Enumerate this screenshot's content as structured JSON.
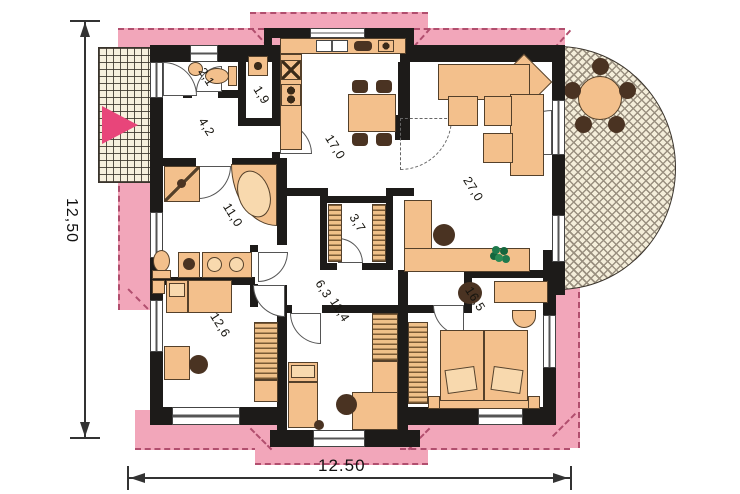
{
  "type": "floor-plan",
  "rooms": [
    {
      "id": "wc",
      "area": "2,1"
    },
    {
      "id": "pantry",
      "area": "1,9"
    },
    {
      "id": "entrance-hall",
      "area": "4,2"
    },
    {
      "id": "kitchen-dining",
      "area": "17,0"
    },
    {
      "id": "bathroom",
      "area": "11,0"
    },
    {
      "id": "walk-in-closet",
      "area": "3,7"
    },
    {
      "id": "living-room",
      "area": "27,0"
    },
    {
      "id": "hallway",
      "area": "6,3"
    },
    {
      "id": "bedroom-left",
      "area": "12,6"
    },
    {
      "id": "bedroom-middle",
      "area": "11,4"
    },
    {
      "id": "bedroom-right",
      "area": "16,5"
    }
  ],
  "dimensions": {
    "left": "12,50",
    "bottom": "12.50"
  },
  "colors": {
    "roof_overhang": "#f2a6ba",
    "roof_edge": "#b14e6e",
    "wall": "#1d1b19",
    "furniture": "#f3c08c",
    "entrance_arrow": "#e8457a",
    "plant": "#1f7a4d"
  }
}
